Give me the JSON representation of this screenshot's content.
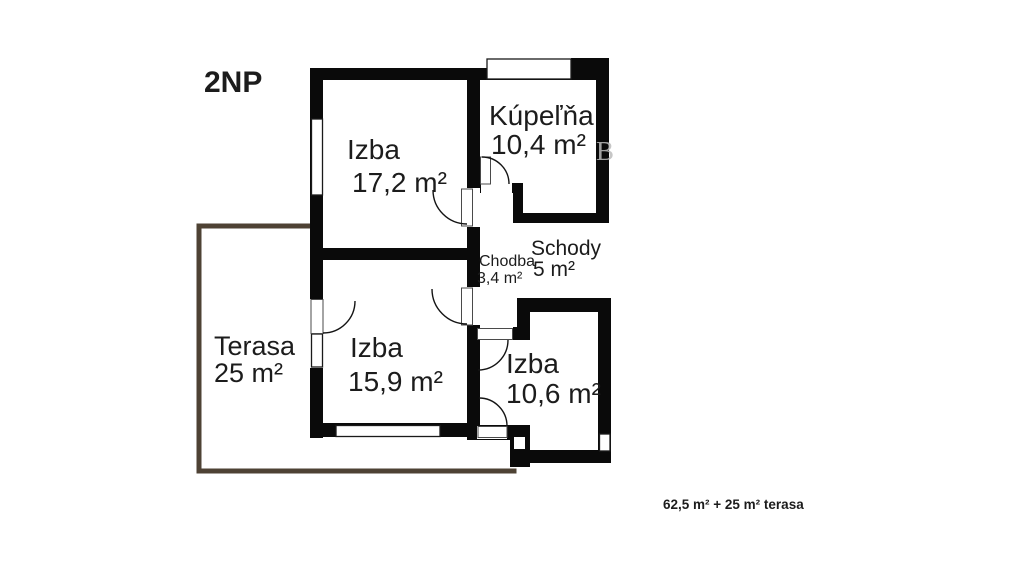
{
  "floor_label": "2NP",
  "rooms": [
    {
      "id": "izba-17",
      "name": "Izba",
      "area": "17,2 m²"
    },
    {
      "id": "kupelna",
      "name": "Kúpeľňa",
      "area": "10,4 m²"
    },
    {
      "id": "chodba",
      "name": "Chodba",
      "area": "3,4 m²"
    },
    {
      "id": "schody",
      "name": "Schody",
      "area": "5 m²"
    },
    {
      "id": "izba-15",
      "name": "Izba",
      "area": "15,9 m²"
    },
    {
      "id": "izba-10",
      "name": "Izba",
      "area": "10,6 m²"
    },
    {
      "id": "terasa",
      "name": "Terasa",
      "area": "25 m²"
    }
  ],
  "summary": "62,5 m² + 25 m² terasa",
  "watermark": "B",
  "colors": {
    "wall": "#0a0a0a",
    "background": "#ffffff",
    "terrace_outline": "#4e4234"
  }
}
